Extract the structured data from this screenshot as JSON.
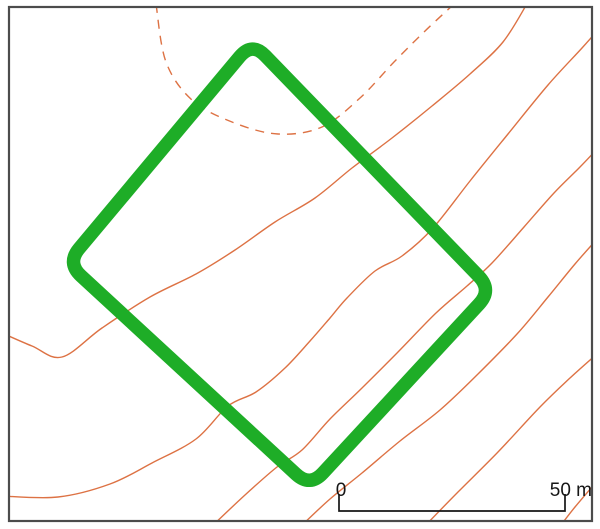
{
  "figure": {
    "kind": "contour site plan with excavation square",
    "colors": {
      "background": "#ffffff",
      "square_green": "#1ead27",
      "contour_orange": "#dd7244",
      "frame_gray": "#4c4c4c",
      "scale_black": "#161616"
    },
    "frame": {
      "x": 9,
      "y": 7,
      "width": 583,
      "height": 514,
      "stroke_width": 2.2
    },
    "square": {
      "corners": [
        [
          252,
          42
        ],
        [
          492,
          290
        ],
        [
          310,
          487
        ],
        [
          67,
          263
        ]
      ],
      "corner_radius": 19,
      "stroke_width": 13.5
    },
    "contours": [
      {
        "id": "dashed-upper-contour",
        "style": "dashed",
        "points": [
          [
            156,
            4
          ],
          [
            166,
            62
          ],
          [
            192,
            100
          ],
          [
            232,
            122
          ],
          [
            278,
            134
          ],
          [
            322,
            127
          ],
          [
            360,
            98
          ],
          [
            394,
            62
          ],
          [
            424,
            32
          ],
          [
            454,
            4
          ]
        ]
      },
      {
        "id": "contour-upper-diagonal",
        "style": "solid",
        "points": [
          [
            2,
            333
          ],
          [
            32,
            346
          ],
          [
            62,
            357
          ],
          [
            102,
            328
          ],
          [
            150,
            297
          ],
          [
            196,
            274
          ],
          [
            235,
            250
          ],
          [
            275,
            222
          ],
          [
            315,
            198
          ],
          [
            352,
            168
          ],
          [
            392,
            138
          ],
          [
            432,
            106
          ],
          [
            470,
            74
          ],
          [
            503,
            42
          ],
          [
            528,
            2
          ]
        ]
      },
      {
        "id": "contour-grand-s",
        "style": "solid",
        "points": [
          [
            2,
            496
          ],
          [
            58,
            497
          ],
          [
            110,
            484
          ],
          [
            152,
            463
          ],
          [
            196,
            439
          ],
          [
            228,
            406
          ],
          [
            256,
            392
          ],
          [
            285,
            368
          ],
          [
            310,
            341
          ],
          [
            330,
            318
          ],
          [
            347,
            298
          ],
          [
            375,
            271
          ],
          [
            402,
            256
          ],
          [
            433,
            228
          ],
          [
            470,
            181
          ],
          [
            508,
            134
          ],
          [
            548,
            85
          ],
          [
            582,
            48
          ],
          [
            598,
            30
          ]
        ]
      },
      {
        "id": "contour-right-1",
        "style": "solid",
        "points": [
          [
            209,
            529
          ],
          [
            245,
            495
          ],
          [
            277,
            467
          ],
          [
            302,
            450
          ],
          [
            330,
            419
          ],
          [
            362,
            388
          ],
          [
            398,
            352
          ],
          [
            436,
            313
          ],
          [
            467,
            286
          ],
          [
            492,
            263
          ],
          [
            524,
            227
          ],
          [
            554,
            193
          ],
          [
            580,
            167
          ],
          [
            598,
            148
          ]
        ]
      },
      {
        "id": "contour-right-2",
        "style": "solid",
        "points": [
          [
            298,
            529
          ],
          [
            330,
            499
          ],
          [
            362,
            473
          ],
          [
            400,
            441
          ],
          [
            440,
            410
          ],
          [
            478,
            374
          ],
          [
            517,
            334
          ],
          [
            548,
            297
          ],
          [
            575,
            264
          ],
          [
            598,
            238
          ]
        ]
      },
      {
        "id": "contour-right-3",
        "style": "solid",
        "points": [
          [
            422,
            529
          ],
          [
            458,
            492
          ],
          [
            498,
            452
          ],
          [
            540,
            407
          ],
          [
            570,
            378
          ],
          [
            598,
            353
          ]
        ]
      },
      {
        "id": "contour-right-4",
        "style": "solid",
        "points": [
          [
            558,
            529
          ],
          [
            575,
            507
          ],
          [
            598,
            480
          ]
        ]
      }
    ],
    "contour_stroke_width": 1.4,
    "dash_pattern": "9 7",
    "scale_bar": {
      "zero_label": "0",
      "end_label": "50 m",
      "x_start": 339,
      "x_end": 565,
      "y": 511,
      "tick_top": 494,
      "stroke_width": 1.7,
      "font_size": 19
    }
  }
}
